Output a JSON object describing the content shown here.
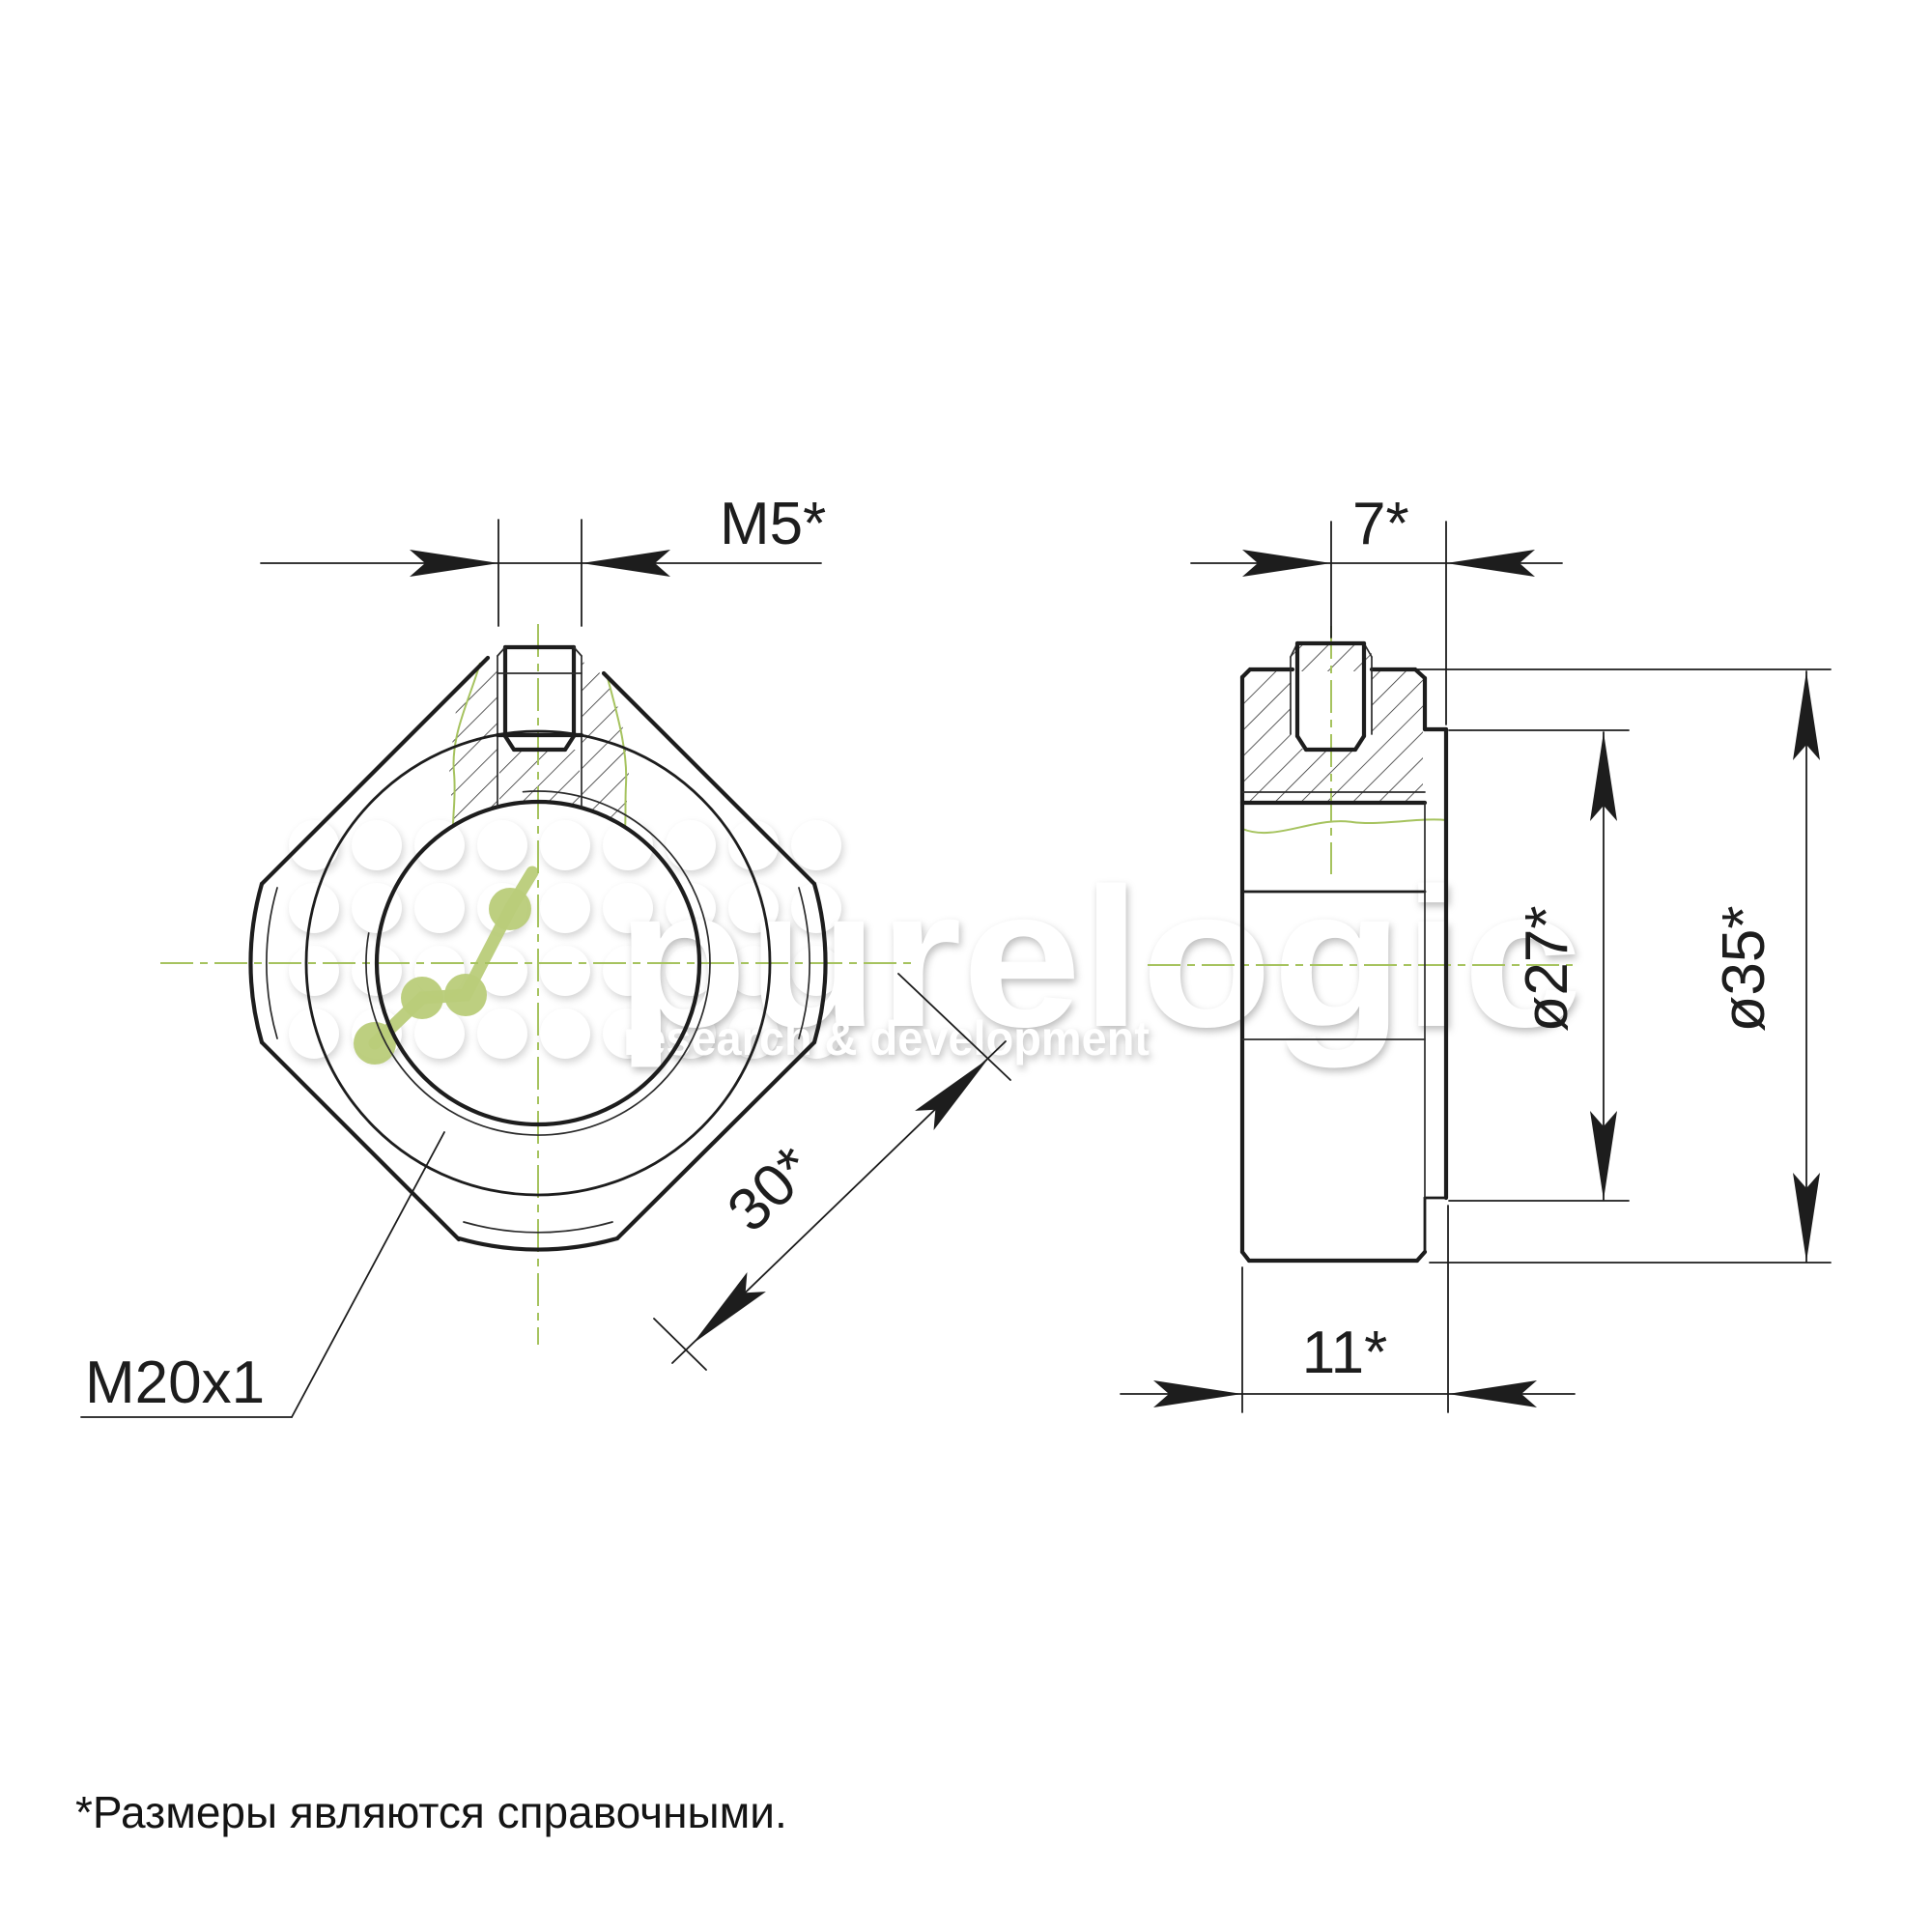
{
  "drawing": {
    "labels": {
      "m5": "M5*",
      "d7": "7*",
      "m20": "M20x1",
      "d30": "30*",
      "d27": "ø27*",
      "d35": "ø35*",
      "d11": "11*"
    },
    "footnote": "*Размеры являются справочными.",
    "watermark": {
      "title": "purelogic",
      "subtitle": "research & development"
    },
    "colors": {
      "line": "#1d1d1d",
      "centerline_green": "#a6c35f",
      "logo_green": "#b9cc79",
      "background": "#ffffff"
    }
  }
}
